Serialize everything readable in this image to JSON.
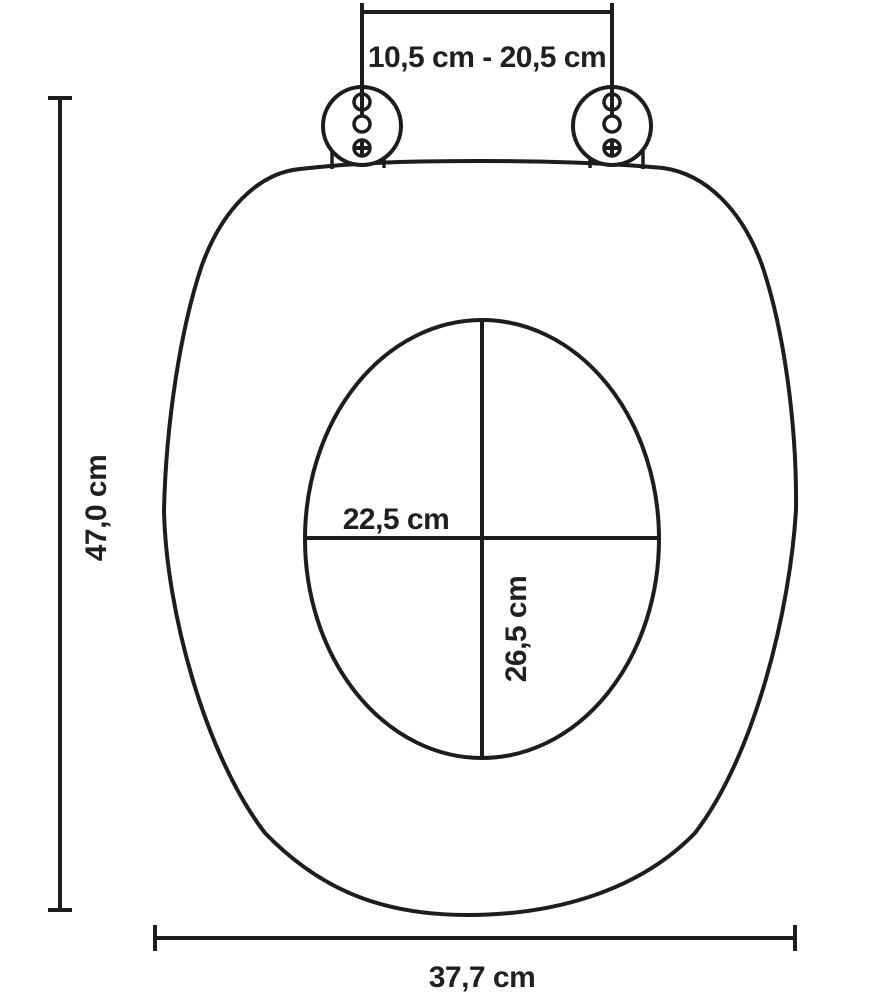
{
  "page": {
    "background": "#ffffff"
  },
  "diagram": {
    "type": "technical-dimension-diagram",
    "subject": "toilet-seat-top-view",
    "line_color": "#1d1d1b",
    "text_color": "#231f20",
    "measurements": {
      "hinge_distance": "10,5 cm - 20,5 cm",
      "overall_length": "47,0 cm",
      "cutout_width": "22,5 cm",
      "cutout_length": "26,5 cm",
      "overall_width": "37,7 cm"
    }
  }
}
